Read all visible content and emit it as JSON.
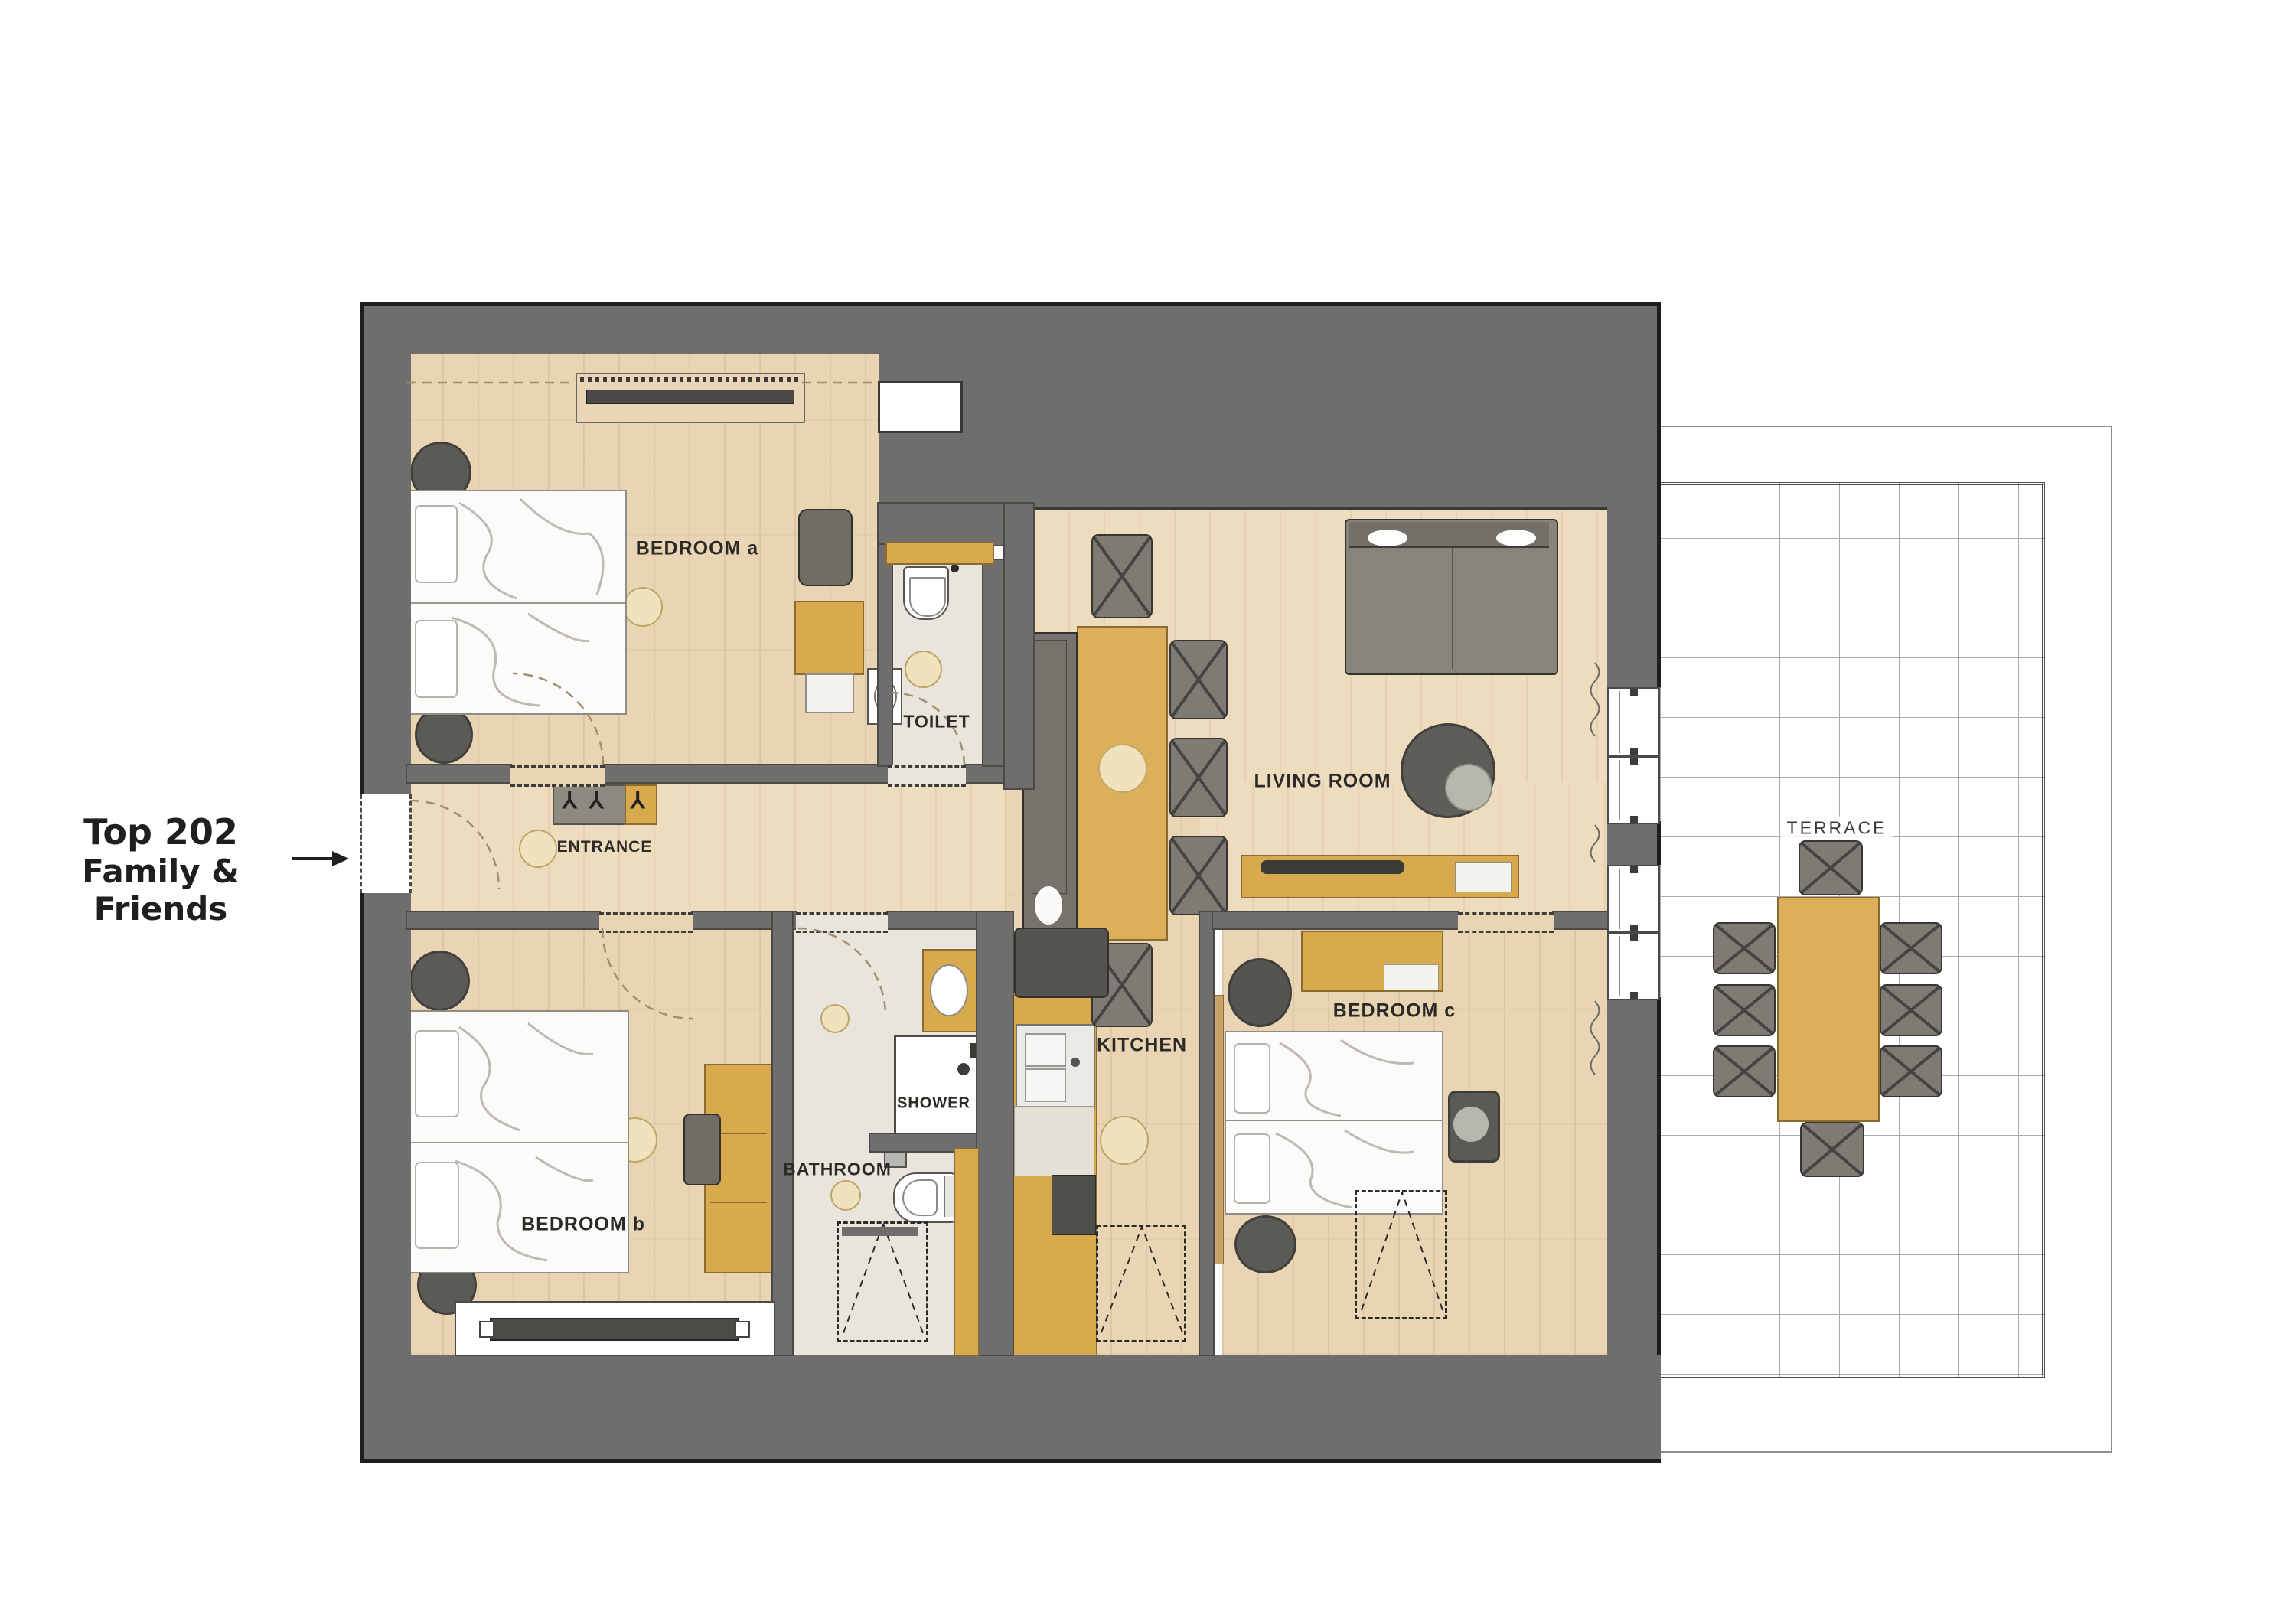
{
  "annotation": {
    "line1": "Top 202",
    "line2": "Family & Friends"
  },
  "rooms": {
    "bedroom_a": "BEDROOM a",
    "toilet": "TOILET",
    "entrance": "ENTRANCE",
    "living_room": "LIVING ROOM",
    "terrace": "TERRACE",
    "bedroom_b": "BEDROOM b",
    "bathroom": "BATHROOM",
    "shower": "SHOWER",
    "kitchen": "KITCHEN",
    "bedroom_c": "BEDROOM c"
  },
  "icons": {
    "coat_hook": "⅄"
  },
  "colors": {
    "wall": "#6f6e6c",
    "wall_outline": "#1f1e1c",
    "wood_floor": "#e9d4b3",
    "furniture_wood": "#d9a94e",
    "upholstery": "#7e7b74",
    "bath_floor": "#e9e5dd",
    "rug_dark": "#5b5a55",
    "rug_beige": "#f0e2bc",
    "terrace_grid": "#ababab"
  }
}
